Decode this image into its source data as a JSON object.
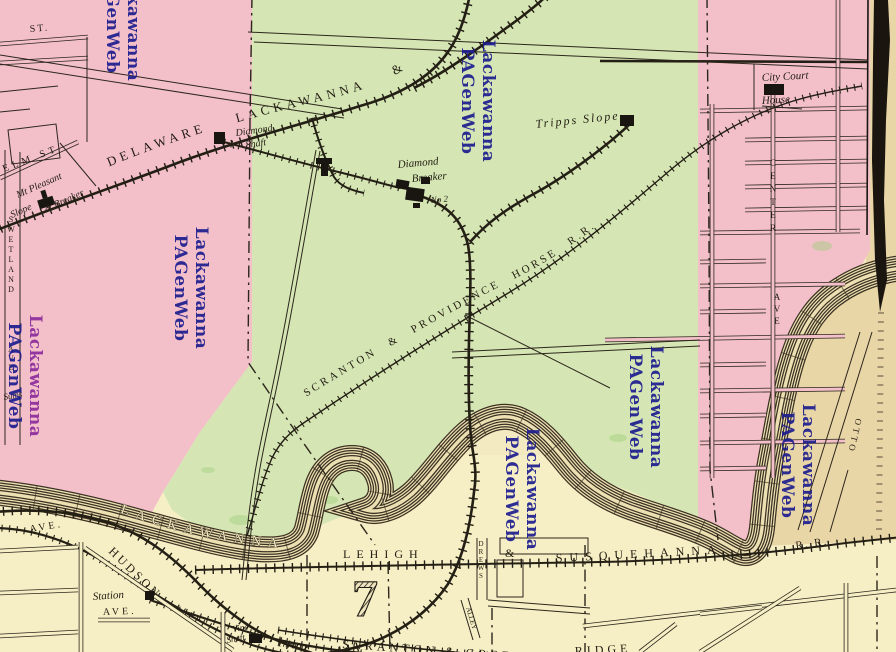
{
  "map": {
    "title": "Providence / Scranton ward map detail",
    "colors": {
      "paper": "#f3eac2",
      "bottom_paper": "#f6efc5",
      "green": "#d5e6b4",
      "pink": "#f3c0ca",
      "tan": "#e9d6a7",
      "ink": "#241f15",
      "watermark_navy": "#1d1d8f",
      "watermark_purple": "#8d2d9c"
    },
    "watermark": {
      "line1": "Lackawanna",
      "line2": "PAGenWeb"
    },
    "labels": {
      "street_st": "ST.",
      "elm_st": "ELM  ST",
      "mt_pleasant_1": "Mt Pleasant",
      "mt_pleasant_2": "Slope",
      "mt_pleasant_3": "& Breaker",
      "swetland": "SWETLAND",
      "swetland_ave": "AVE.",
      "sums": "Sums",
      "dlw_rr": "DELAWARE LACKAWANNA &",
      "diamond_shaft_1": "Diamond",
      "diamond_shaft_2": "Shaft",
      "diamond_breaker_1": "Diamond",
      "diamond_breaker_2": "Breaker",
      "diamond_breaker_3": "No 2",
      "tripps_slope": "Tripps Slope",
      "city_court_1": "City Court",
      "city_court_2": "House",
      "sph_rr": "SCRANTON & PROVIDENCE HORSE R.R.",
      "center_st": "CENTER",
      "center_ave": "AVE",
      "otto": "OTTO",
      "river_name": "LACKAWANNA",
      "ave_1": "AVE.",
      "ave_2": "AVE.",
      "hudson": "HUDSON",
      "station": "Station",
      "lehigh": "LEHIGH",
      "ampersand": "&",
      "susquehanna": "SUSQUEHANNA",
      "rr": "R. R.",
      "ward_number": "7",
      "drews": "DREWS",
      "alley": "ALLEY",
      "green_ridge": "SCRANTON & GREEN",
      "ridge": "RIDGE",
      "vine_1": "Vine",
      "vine_2": "Shaft",
      "throop": "Throop"
    }
  }
}
